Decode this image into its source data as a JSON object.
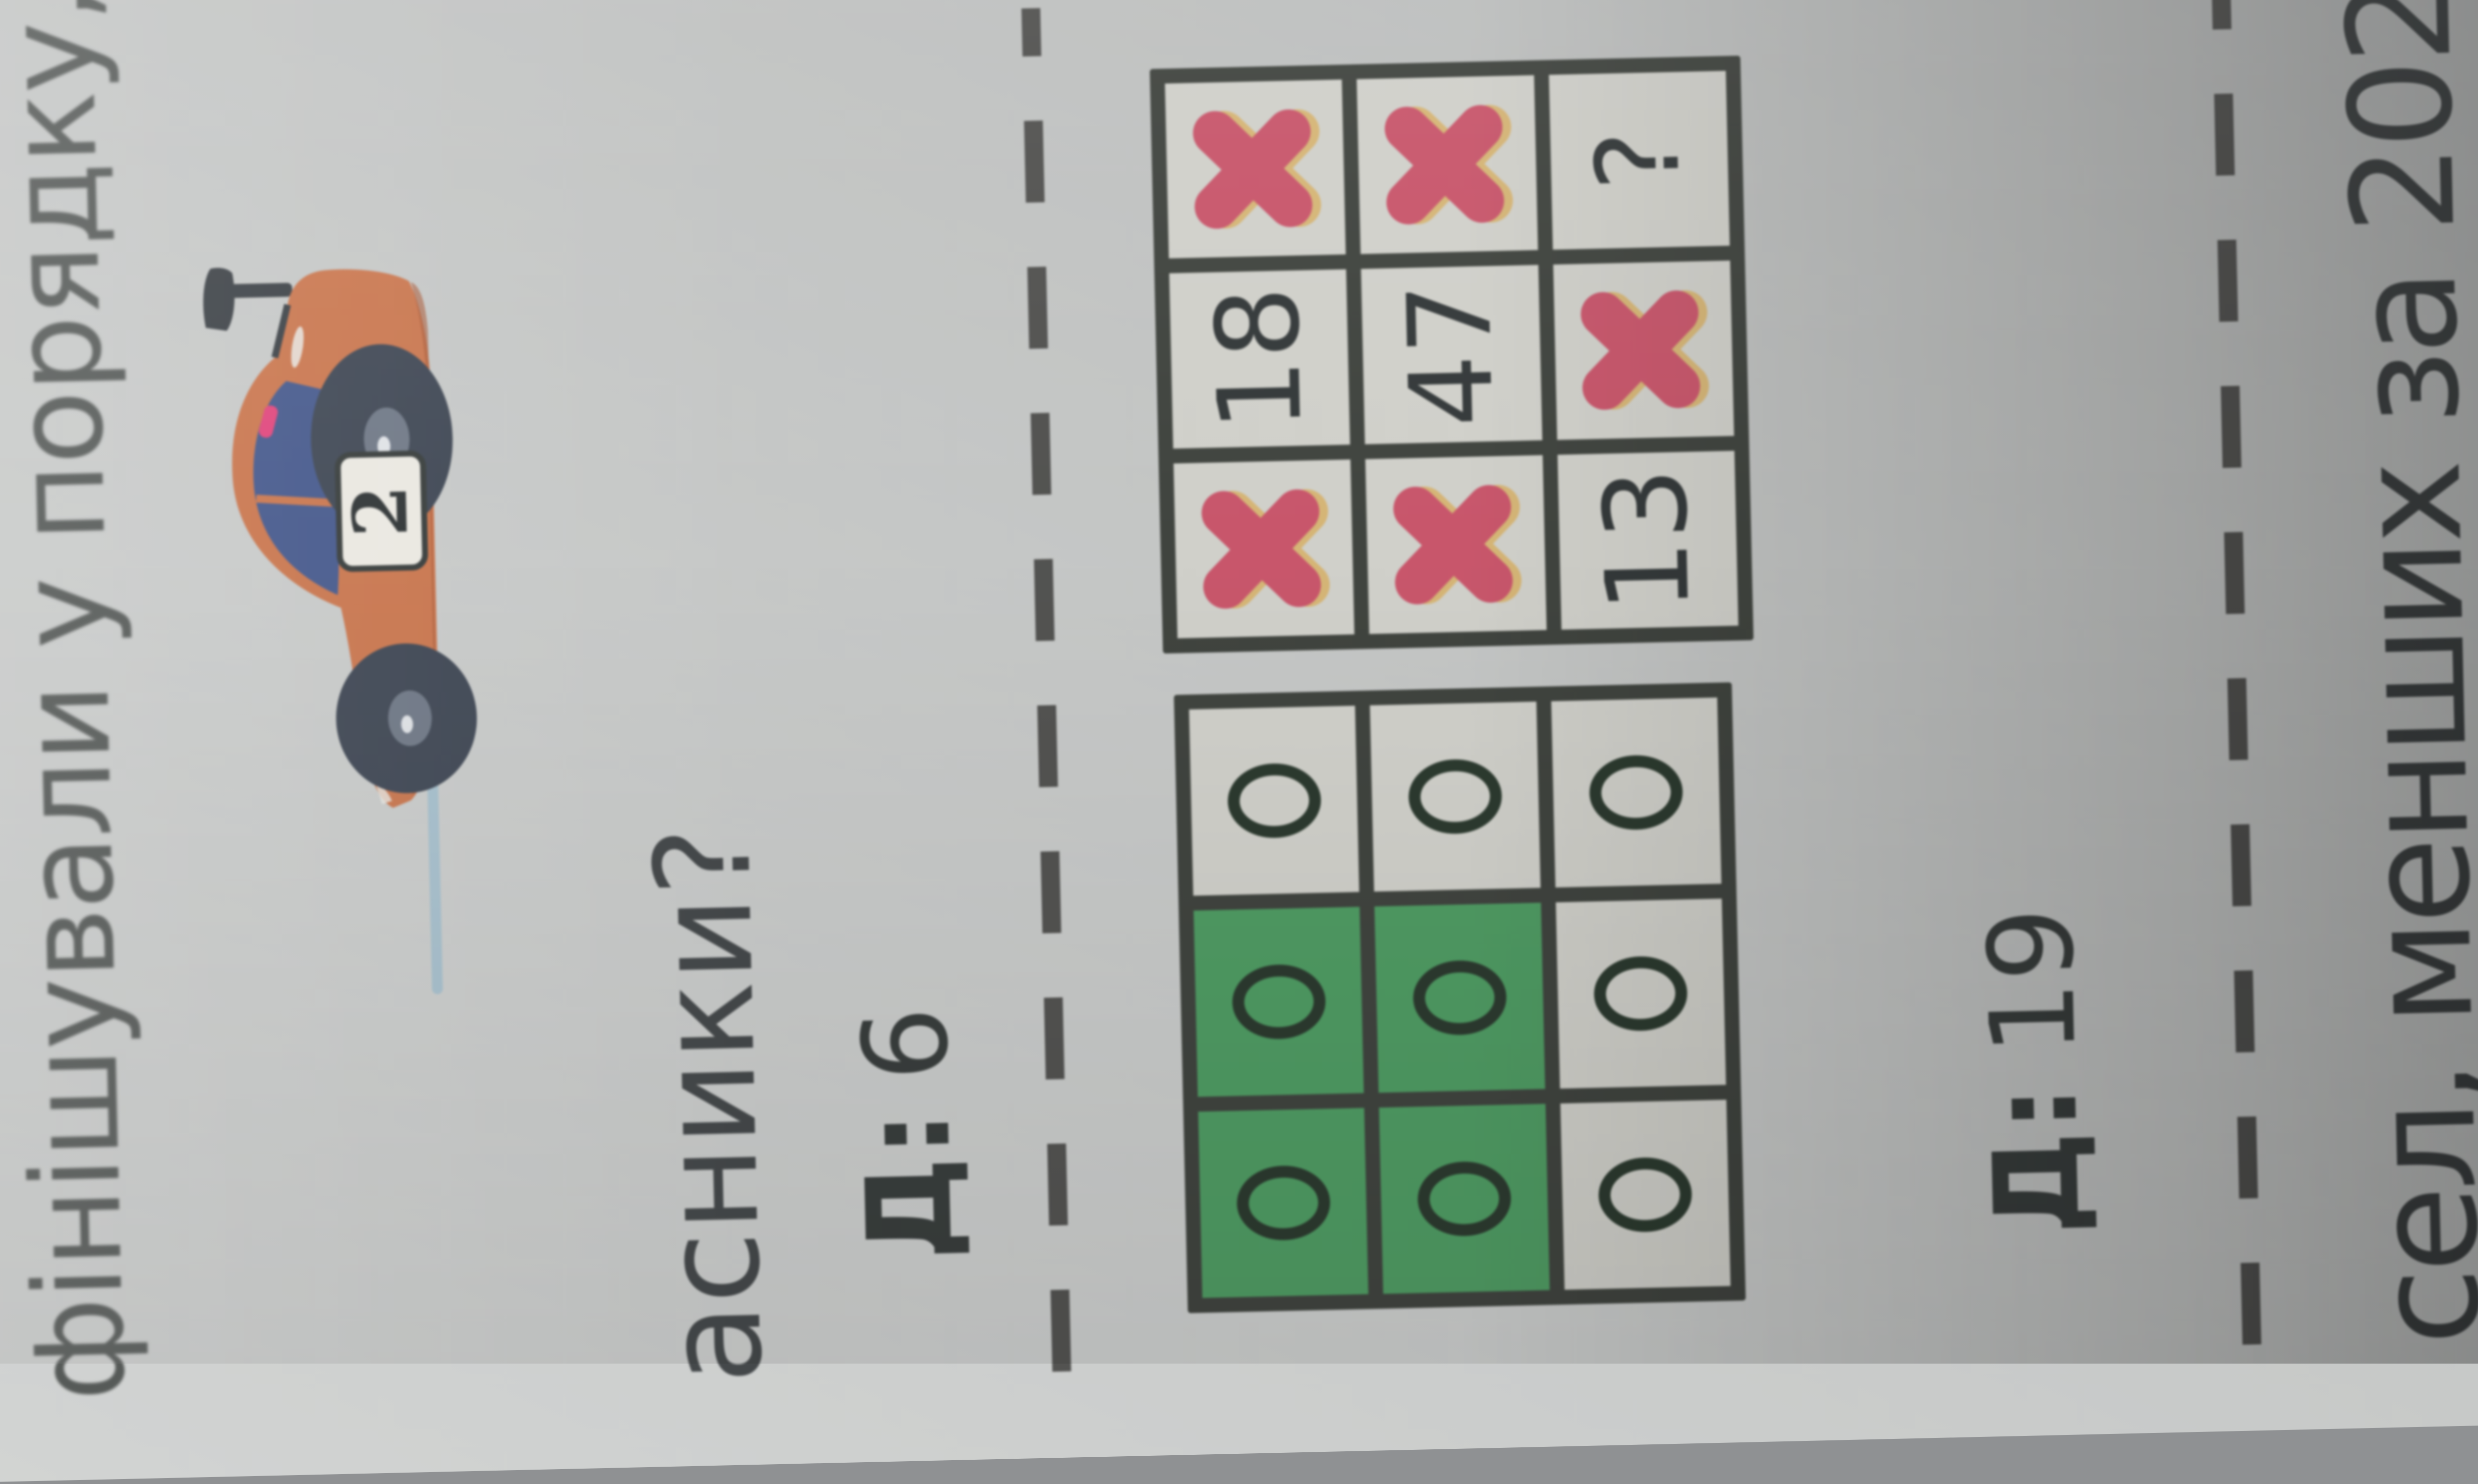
{
  "exercise_top": {
    "text_fragment": "фінішували у порядку,"
  },
  "car": {
    "number": "2"
  },
  "question_fragment": "асники?",
  "answers": {
    "a1": {
      "label": "Д:",
      "value": "6"
    },
    "a2": {
      "label": "Д:",
      "value": "19"
    }
  },
  "grids": {
    "zeros": {
      "cells": [
        [
          "0",
          "0",
          "0"
        ],
        [
          "0",
          "0",
          "0"
        ],
        [
          "0",
          "0",
          "0"
        ]
      ],
      "green": [
        [
          0,
          0
        ],
        [
          0,
          1
        ],
        [
          1,
          0
        ],
        [
          1,
          1
        ]
      ]
    },
    "marks": {
      "cells": [
        [
          "X",
          "18",
          "X"
        ],
        [
          "X",
          "47",
          "X"
        ],
        [
          "13",
          "X",
          "?"
        ]
      ]
    }
  },
  "bottom_fragment": "сел, менших за 2021,",
  "colors": {
    "x_mark": "#c8566b",
    "x_shadow": "#d9a43e",
    "green_cell": "#4f9b63",
    "grid_line": "#40443f",
    "car_body": "#c9764e",
    "paper": "#c6c8c7"
  }
}
